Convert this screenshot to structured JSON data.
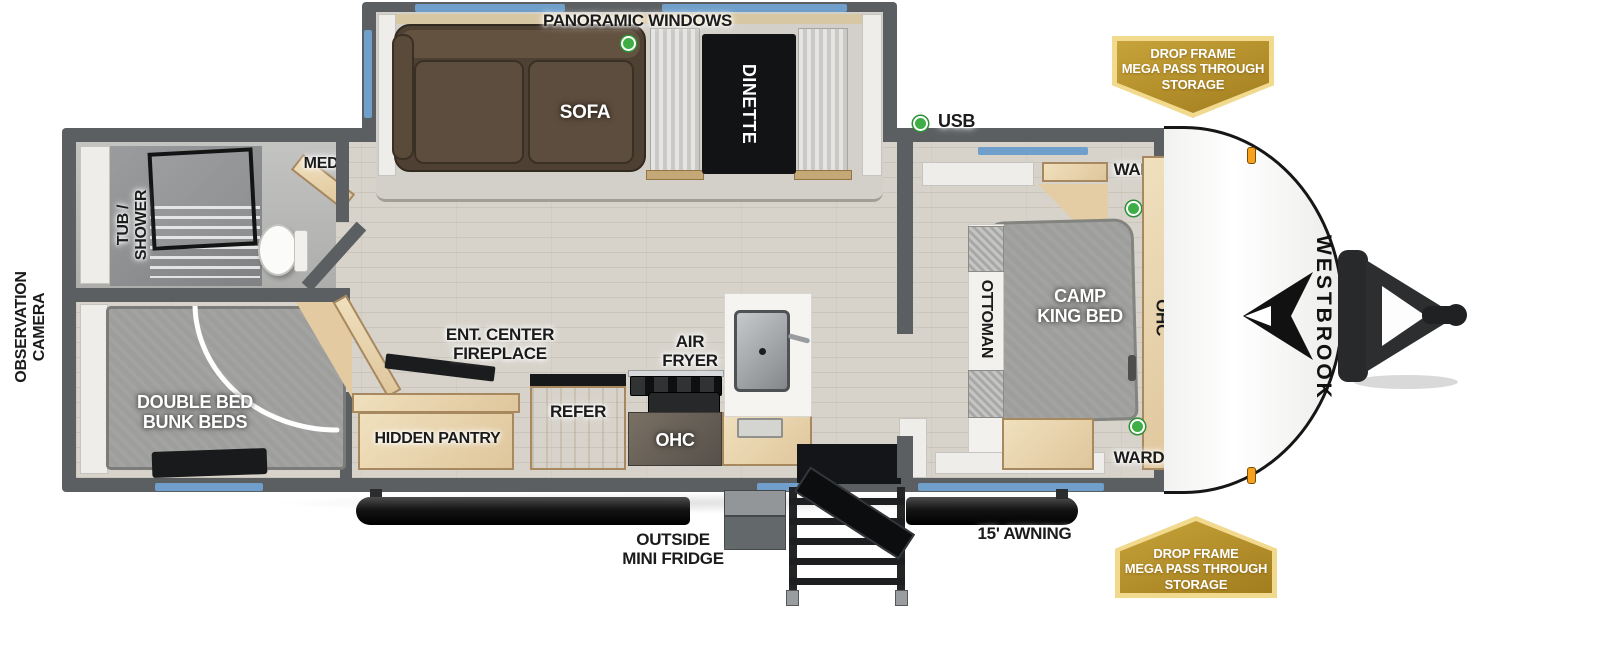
{
  "brand": {
    "name": "WESTBROOK"
  },
  "colors": {
    "wall": "#5b5f61",
    "floor_wood": "#d7d3cb",
    "cabinet_wood": "#e8d4ac",
    "window_blue": "#6f9fca",
    "indicator_green": "#3fae46",
    "marker_orange": "#f6a21c",
    "badge_gold": "#b8922f",
    "sofa_brown": "#4e4134",
    "bed_gray": "#9e9e9c"
  },
  "exterior": {
    "panoramic_windows": "PANORAMIC WINDOWS",
    "usb": "USB",
    "observation_camera": {
      "line1": "OBSERVATION",
      "line2": "CAMERA"
    },
    "outside_mini_fridge": {
      "line1": "OUTSIDE",
      "line2": "MINI FRIDGE"
    },
    "awning": "15' AWNING",
    "badge_top": {
      "line1": "DROP FRAME",
      "line2": "MEGA PASS THROUGH",
      "line3": "STORAGE"
    },
    "badge_bottom": {
      "line1": "DROP FRAME",
      "line2": "MEGA PASS THROUGH",
      "line3": "STORAGE"
    }
  },
  "bathroom": {
    "tub_shower": {
      "line1": "TUB /",
      "line2": "SHOWER"
    },
    "med": "MED"
  },
  "bunk_room": {
    "bed": {
      "line1": "DOUBLE BED",
      "line2": "BUNK BEDS"
    }
  },
  "living": {
    "sofa": "SOFA",
    "dinette": "DINETTE"
  },
  "kitchen": {
    "ent_center": {
      "line1": "ENT. CENTER",
      "line2": "FIREPLACE"
    },
    "hidden_pantry": "HIDDEN PANTRY",
    "refer": "REFER",
    "air_fryer": {
      "line1": "AIR",
      "line2": "FRYER"
    },
    "ohc": "OHC"
  },
  "bedroom": {
    "bed": {
      "line1": "CAMP",
      "line2": "KING BED"
    },
    "ottoman": "OTTOMAN",
    "ward_top": "WARD",
    "ward_bottom": "WARD",
    "ohc": "OHC"
  }
}
